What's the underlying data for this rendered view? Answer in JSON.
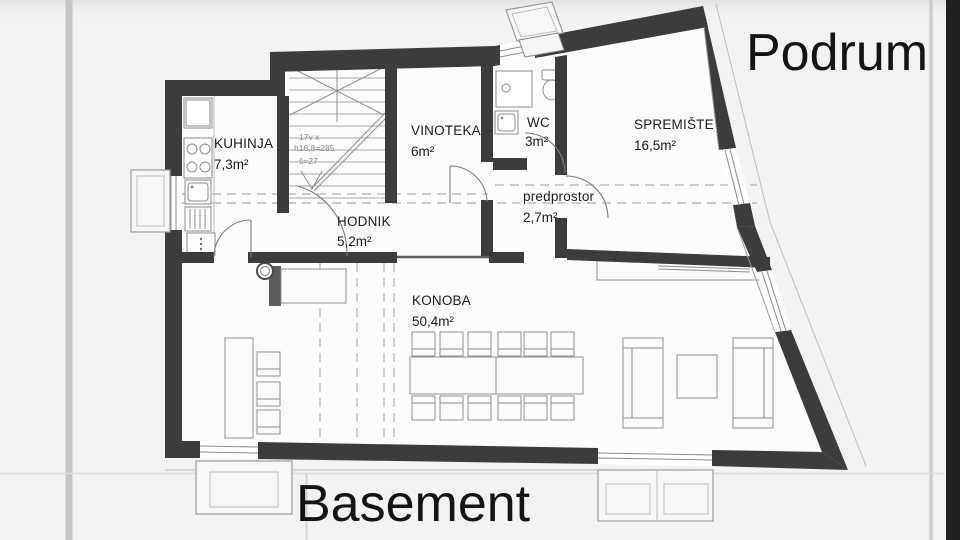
{
  "titles": {
    "plan_label_top": "Podrum",
    "plan_label_bottom": "Basement"
  },
  "rooms": {
    "kuhinja": {
      "name": "KUHINJA",
      "area": "7,3m²"
    },
    "vinoteka": {
      "name": "VINOTEKA",
      "area": "6m²"
    },
    "wc": {
      "name": "WC",
      "area": "3m²"
    },
    "spremiste": {
      "name": "SPREMIŠTE",
      "area": "16,5m²"
    },
    "predprostor": {
      "name": "predprostor",
      "area": "2,7m²"
    },
    "hodnik": {
      "name": "HODNIK",
      "area": "5,2m²"
    },
    "konoba": {
      "name": "KONOBA",
      "area": "50,4m²"
    }
  },
  "stairs": {
    "annotation_line1": "17v x",
    "annotation_line2": "h16,8=285",
    "annotation_line3": "š=27"
  },
  "colors": {
    "wall": "#3c3c3a",
    "backdrop": "#f4f3f1",
    "text": "#141414"
  }
}
